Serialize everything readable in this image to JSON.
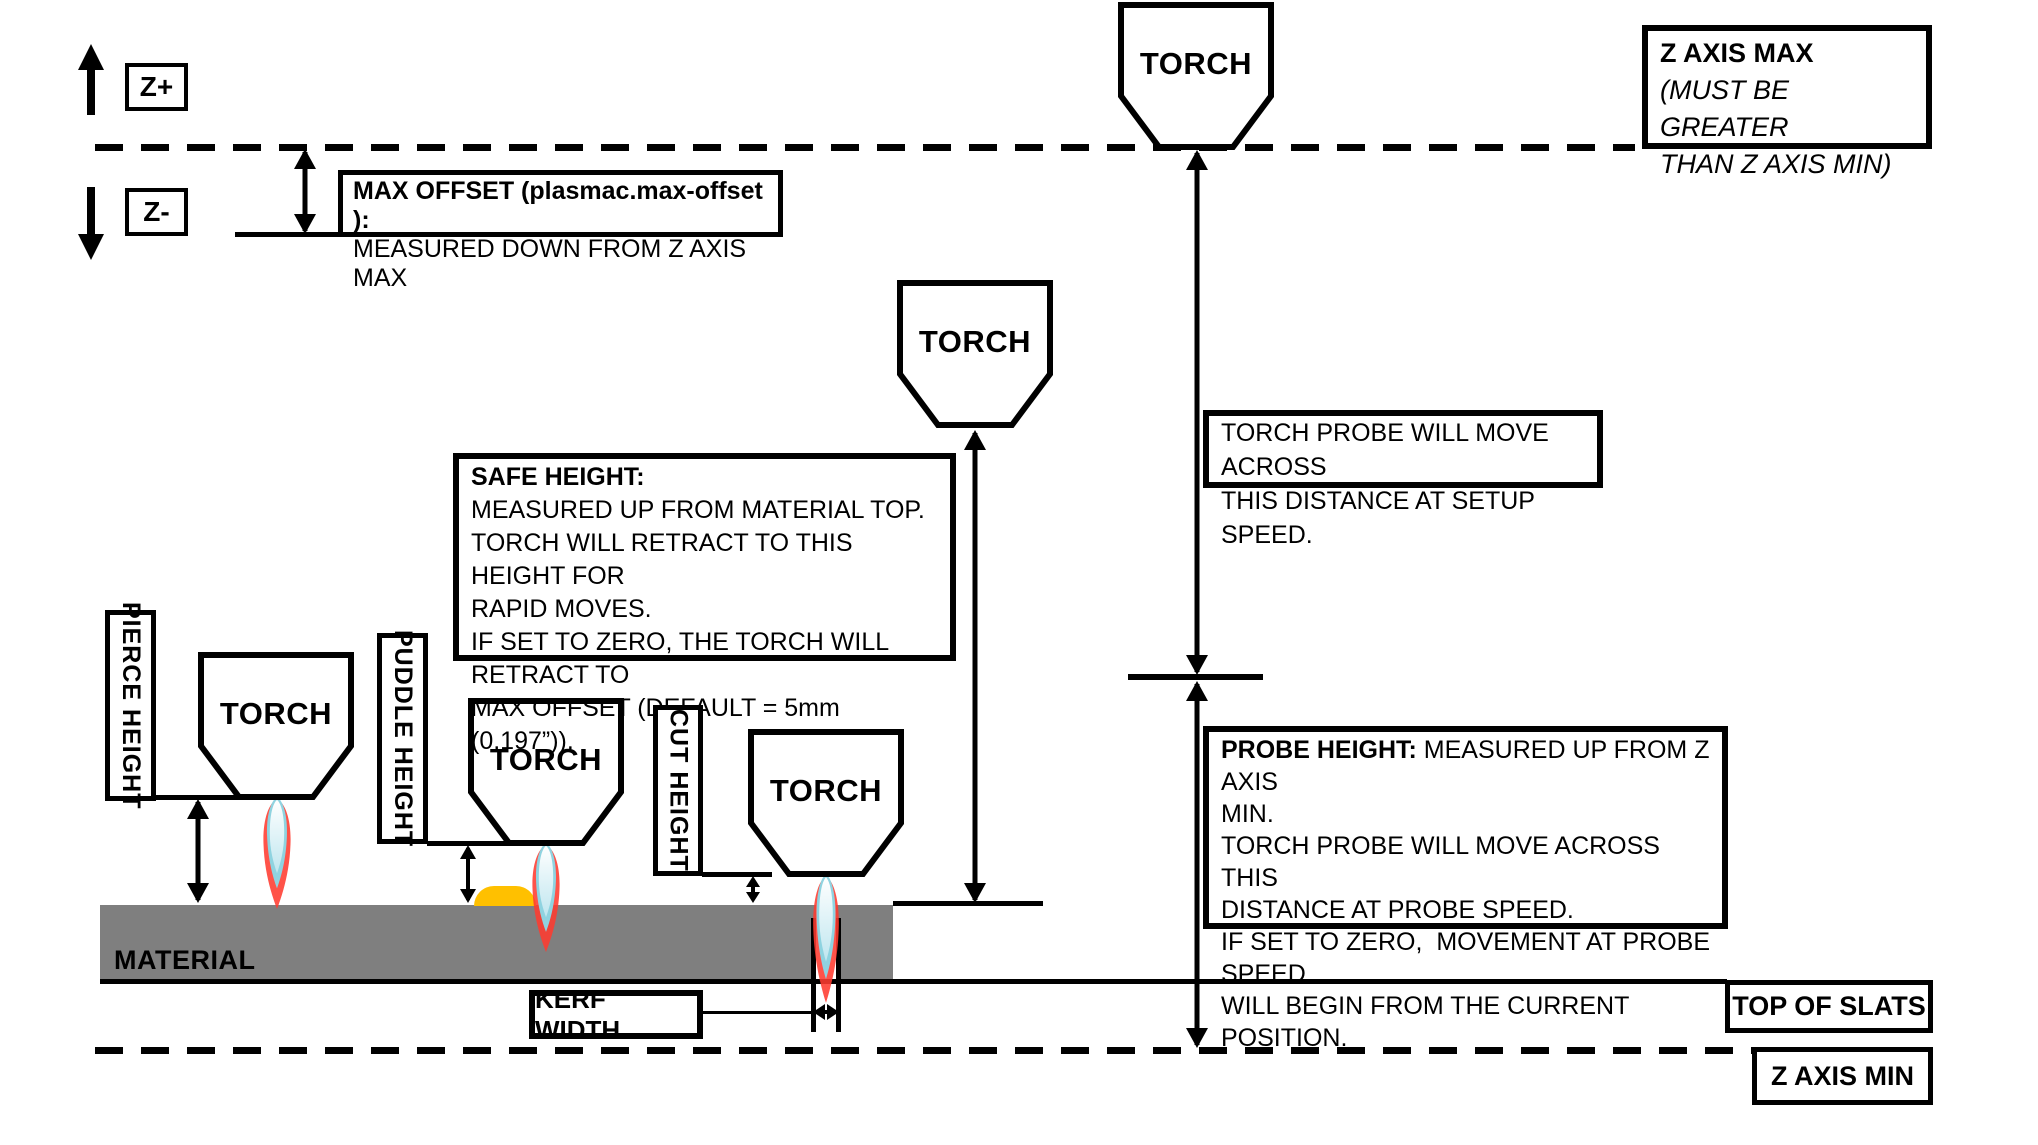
{
  "torch": {
    "label": "TORCH"
  },
  "axes": {
    "z_plus": "Z+",
    "z_minus": "Z-",
    "z_axis_max": {
      "title": "Z AXIS MAX",
      "note1": "(MUST BE GREATER",
      "note2": "THAN Z AXIS MIN)"
    },
    "z_axis_min": "Z AXIS MIN",
    "top_of_slats": "TOP OF SLATS"
  },
  "callouts": {
    "max_offset": {
      "line1": "MAX OFFSET (plasmac.max-offset ):",
      "line2": "MEASURED DOWN FROM Z AXIS MAX"
    },
    "torch_probe": {
      "line1": "TORCH PROBE WILL MOVE ACROSS",
      "line2": "THIS DISTANCE AT SETUP SPEED."
    },
    "safe_height": {
      "title": "SAFE HEIGHT:",
      "line2": "MEASURED UP FROM MATERIAL TOP.",
      "line3": "TORCH WILL RETRACT TO THIS HEIGHT FOR",
      "line4": "RAPID MOVES.",
      "line5": "IF SET TO ZERO, THE TORCH WILL RETRACT TO",
      "line6": "MAX OFFSET (DEFAULT = 5mm (0.197”))."
    },
    "probe_height": {
      "title": "PROBE HEIGHT:",
      "title_rest": " MEASURED UP FROM Z AXIS",
      "line2": "MIN.",
      "line3": "TORCH PROBE WILL MOVE ACROSS THIS",
      "line4": "DISTANCE AT PROBE SPEED.",
      "line5": "IF SET TO ZERO,  MOVEMENT AT PROBE SPEED",
      "line6": "WILL BEGIN FROM THE CURRENT POSITION."
    }
  },
  "measurements": {
    "pierce_height": "PIERCE HEIGHT",
    "puddle_height": "PUDDLE HEIGHT",
    "cut_height": "CUT HEIGHT",
    "kerf_width": "KERF WIDTH"
  },
  "material": {
    "label": "MATERIAL"
  },
  "colors": {
    "line_black": "#000000",
    "material_gray": "#7f7f7f",
    "puddle_orange": "#ffc000",
    "flame_red": "#ff3b30",
    "flame_blue": "#8fd3e0",
    "flame_core_light": "#bfe6ef"
  }
}
